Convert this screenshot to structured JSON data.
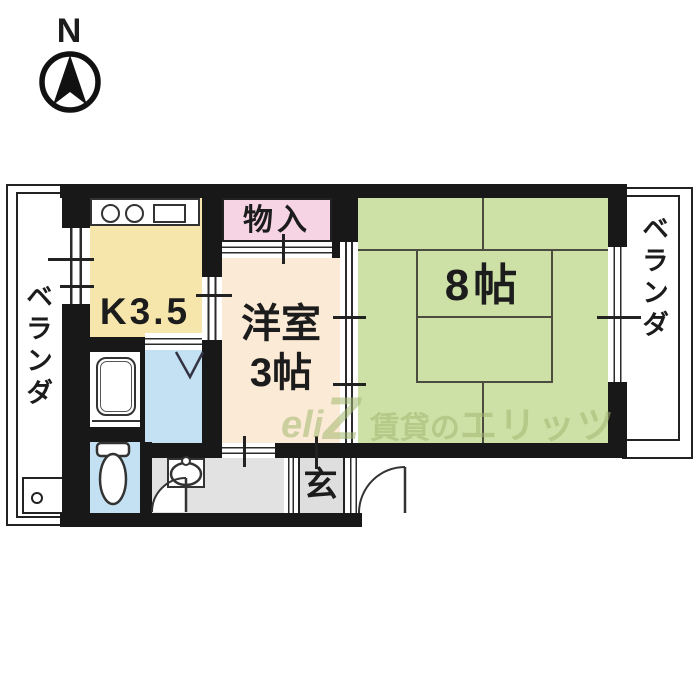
{
  "compass": {
    "label": "N"
  },
  "floor_plan": {
    "verandas": {
      "left": "ベランダ",
      "right": "ベランダ"
    },
    "kitchen": {
      "label": "K3.5",
      "color": "#f6e6ac"
    },
    "closet": {
      "label": "物入",
      "color": "#f7d4e4"
    },
    "western_room": {
      "line1": "洋室",
      "line2": "3帖",
      "color": "#fbead6"
    },
    "tatami_room": {
      "label": "8帖",
      "color": "#cde0a6"
    },
    "entrance": {
      "label": "玄",
      "color": "#dedede"
    },
    "washroom_color": "#c3e1f2",
    "toilet_room_color": "#c3e1f2",
    "hallway_color": "#e2e2e2",
    "wall_color": "#181818"
  },
  "watermark": {
    "logo_script": "eli",
    "logo_letter": "Z",
    "brand_prefix": "賃貸の",
    "brand_name": "エリッツ",
    "color": "rgba(163,184,112,0.55)"
  }
}
